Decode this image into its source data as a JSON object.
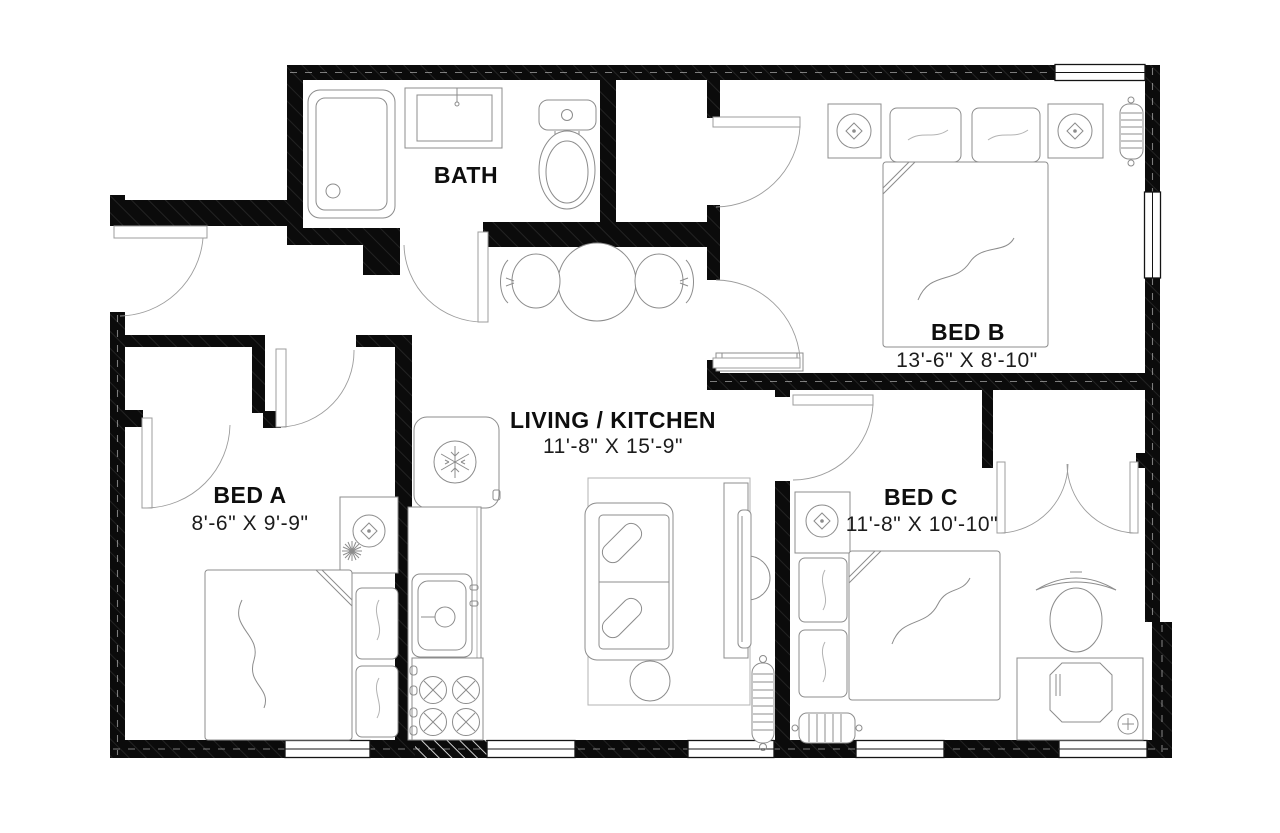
{
  "plan": {
    "rooms": {
      "bath": {
        "label": "BATH"
      },
      "living_kitchen": {
        "label": "LIVING / KITCHEN",
        "dimensions": "11'-8\" X 15'-9\""
      },
      "bed_a": {
        "label": "BED A",
        "dimensions": "8'-6\" X 9'-9\""
      },
      "bed_b": {
        "label": "BED B",
        "dimensions": "13'-6\" X 8'-10\""
      },
      "bed_c": {
        "label": "BED C",
        "dimensions": "11'-8\" X 10'-10\""
      }
    },
    "colors": {
      "wall": "#0b0b0b",
      "furniture_line": "#8c8c8c",
      "background": "#ffffff",
      "text": "#0e0e0e"
    }
  }
}
